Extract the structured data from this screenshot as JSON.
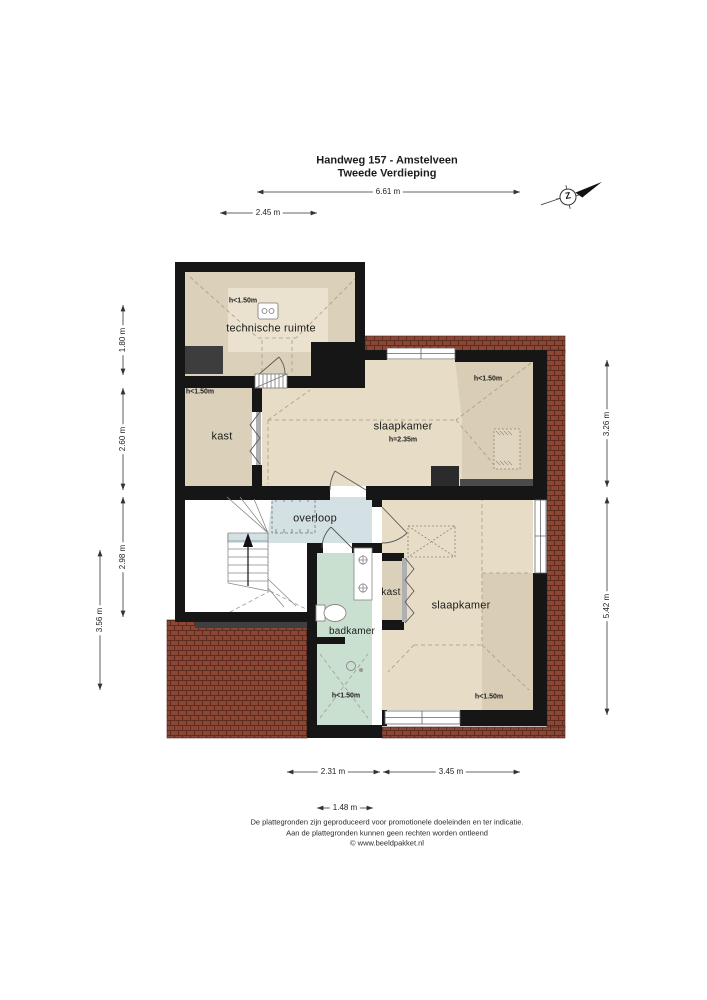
{
  "header": {
    "title": "Handweg 157 - Amstelveen",
    "subtitle": "Tweede Verdieping"
  },
  "compass": {
    "south_label": "Z"
  },
  "dimensions": {
    "top": "6.61 m",
    "top_secondary": "2.45 m",
    "left": [
      "1.80 m",
      "2.60 m",
      "2.98 m"
    ],
    "left_outer": "3.56 m",
    "right": [
      "3.26 m",
      "5.42 m"
    ],
    "bottom": [
      "2.31 m",
      "3.45 m"
    ],
    "bottom_secondary": "1.48 m"
  },
  "rooms": {
    "technische_ruimte": {
      "label": "technische ruimte",
      "height_note": "h<1.50m"
    },
    "kast_boven": {
      "label": "kast",
      "height_note": "h<1.50m"
    },
    "slaapkamer_1": {
      "label": "slaapkamer",
      "ceiling_height": "h=2.35m",
      "height_note": "h<1.50m"
    },
    "overloop": {
      "label": "overloop"
    },
    "badkamer": {
      "label": "badkamer",
      "height_note": "h<1.50m"
    },
    "kast_onder": {
      "label": "kast"
    },
    "slaapkamer_2": {
      "label": "slaapkamer",
      "height_note": "h<1.50m"
    }
  },
  "footer": {
    "line1": "De plattegronden zijn geproduceerd voor promotionele doeleinden en ter indicatie.",
    "line2": "Aan de plattegronden kunnen geen rechten worden ontleend",
    "line3": "© www.beeldpakket.nl"
  },
  "colors": {
    "wall": "#161616",
    "floor_light": "#e7ddc7",
    "floor_shaded": "#d9ceb5",
    "floor_dark_room": "#dbd1ba",
    "overloop_fill": "#d3e0e4",
    "badkamer_fill": "#c9e0d0",
    "roof_tile": "#8b4734",
    "roof_tile_line": "#5c2c20"
  }
}
